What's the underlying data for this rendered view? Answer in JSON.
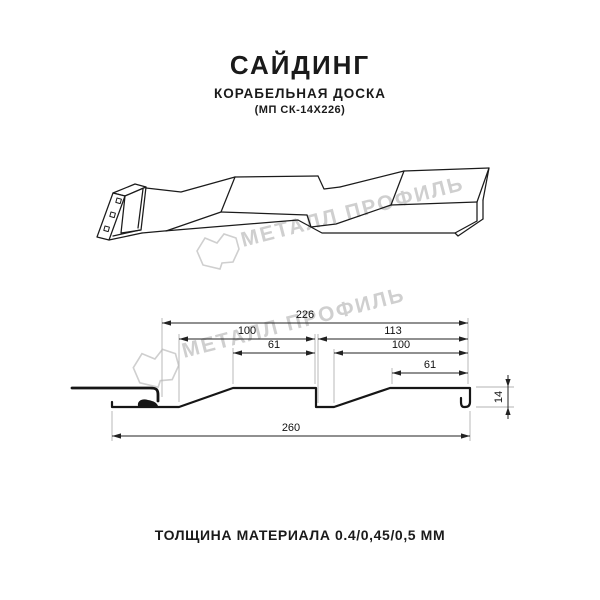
{
  "header": {
    "title": "САЙДИНГ",
    "subtitle": "КОРАБЕЛЬНАЯ ДОСКА",
    "model": "(МП СК-14Х226)"
  },
  "watermark": {
    "text": "МЕТАЛЛ ПРОФИЛЬ",
    "color": "#cfcfcf"
  },
  "dimensions": {
    "overall_top": "226",
    "left_panel": "100",
    "right_section": "113",
    "left_flat": "61",
    "right_panel": "100",
    "right_flat": "61",
    "profile_height": "14",
    "overall_bottom": "260"
  },
  "footer": {
    "text": "ТОЛЩИНА МАТЕРИАЛА 0.4/0,45/0,5 ММ"
  },
  "drawing": {
    "line_color": "#1b1b1b",
    "dim_color": "#222222",
    "ext_color": "#b3b3b3"
  }
}
